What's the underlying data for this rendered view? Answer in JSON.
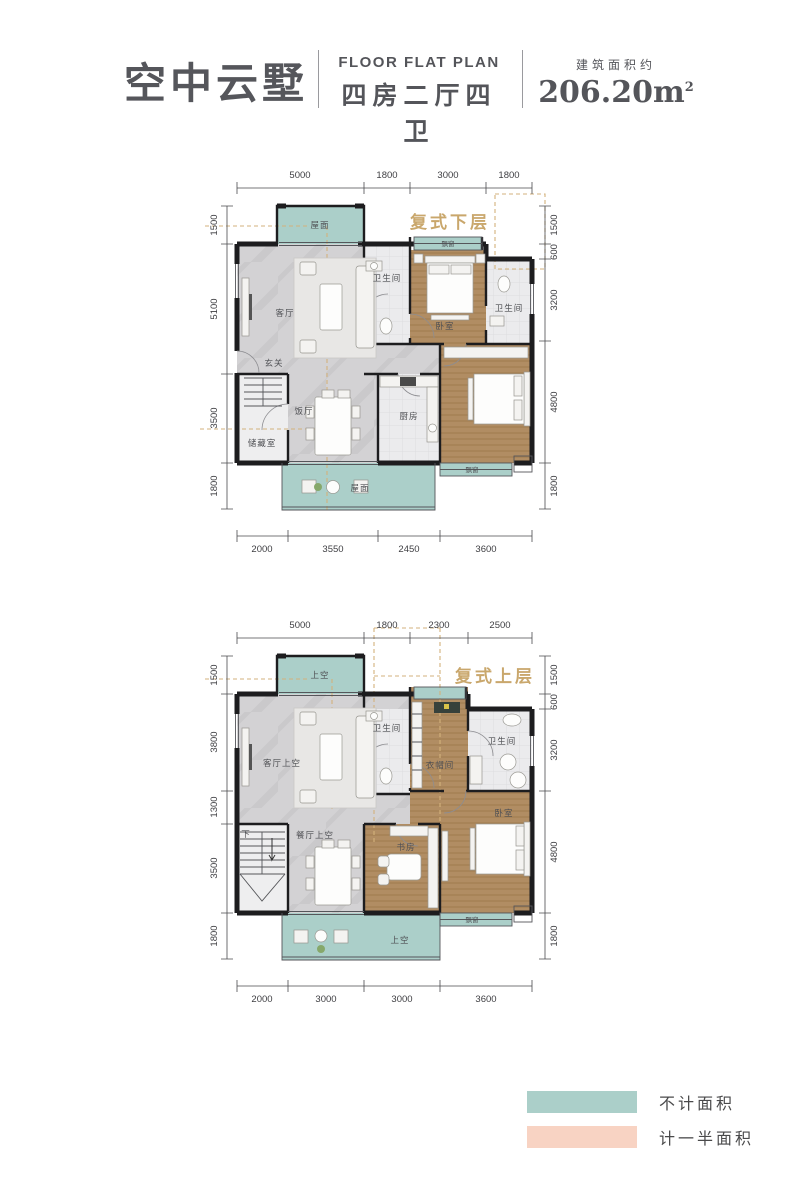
{
  "header": {
    "title": "空中云墅",
    "subtitle_en": "FLOOR FLAT PLAN",
    "subtitle_cn": "四房二厅四卫",
    "area_label": "建筑面积约",
    "area_value": "206.20",
    "area_unit": "m",
    "area_sup": "2"
  },
  "plans": {
    "lower": {
      "name": "复式下层",
      "dims_top": [
        "5000",
        "1800",
        "3000",
        "1800"
      ],
      "dims_bottom": [
        "2000",
        "3550",
        "2450",
        "3600"
      ],
      "dims_left": [
        "1500",
        "5100",
        "3500",
        "1800"
      ],
      "dims_right": [
        "1500",
        "600",
        "3200",
        "4800",
        "1800"
      ],
      "rooms": {
        "roof_top": "屋面",
        "living": "客厅",
        "foyer": "玄关",
        "bath_center": "卫生间",
        "bay_top": "飘窗",
        "bedroom_top": "卧室",
        "bath_right": "卫生间",
        "storage": "储藏室",
        "dining": "饭厅",
        "kitchen": "厨房",
        "bay_bottom": "飘窗",
        "roof_bottom": "屋面"
      }
    },
    "upper": {
      "name": "复式上层",
      "dims_top": [
        "5000",
        "1800",
        "2300",
        "2500"
      ],
      "dims_bottom": [
        "2000",
        "3000",
        "3000",
        "3600"
      ],
      "dims_left": [
        "1500",
        "3800",
        "1300",
        "3500",
        "1800"
      ],
      "dims_right": [
        "1500",
        "600",
        "3200",
        "4800",
        "1800"
      ],
      "rooms": {
        "void_top": "上空",
        "living_void": "客厅上空",
        "bath_center": "卫生间",
        "cloakroom": "衣帽间",
        "bath_right": "卫生间",
        "stairs_down": "下",
        "dining_void": "餐厅上空",
        "study": "书房",
        "bedroom": "卧室",
        "bay_bottom": "飘窗",
        "void_bottom": "上空"
      }
    }
  },
  "legend": {
    "items": [
      {
        "label": "不计面积",
        "color": "#abcfc9"
      },
      {
        "label": "计一半面积",
        "color": "#f8d3c3"
      }
    ]
  },
  "colors": {
    "accent_gold": "#c9a76c",
    "wall_black": "#1d1d1f",
    "title_gray": "#55565b"
  }
}
